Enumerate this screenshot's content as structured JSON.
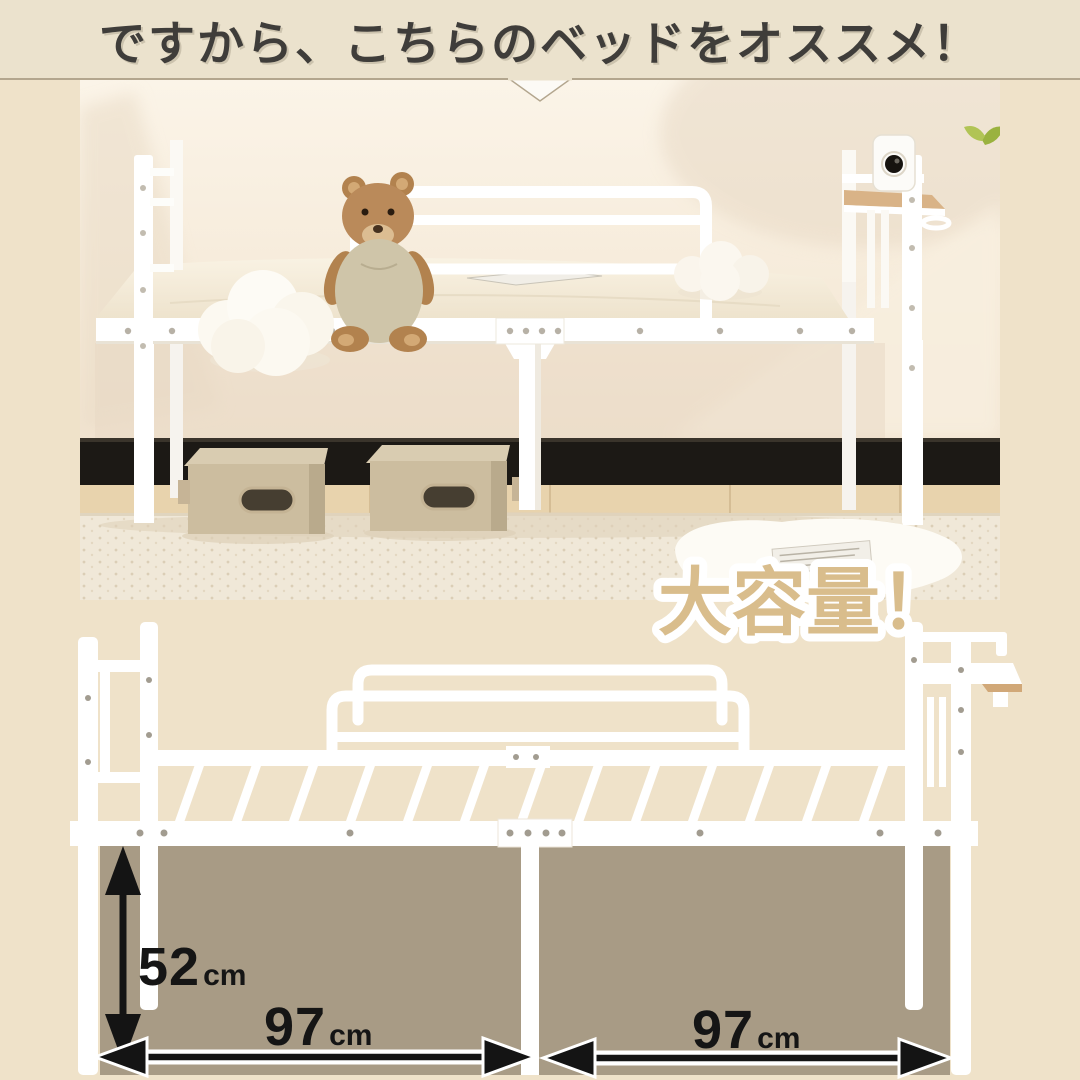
{
  "header": {
    "headline": "ですから、こちらのベッドをオススメ！"
  },
  "badge": {
    "label": "大容量！"
  },
  "diagram": {
    "height_dim": {
      "value": "52",
      "unit": "cm"
    },
    "width_dim_left": {
      "value": "97",
      "unit": "cm"
    },
    "width_dim_right": {
      "value": "97",
      "unit": "cm"
    }
  },
  "colors": {
    "page_background": "#efe2c9",
    "header_band": "#ebe2cd",
    "headline_text": "#3f3d3a",
    "badge_fill": "#d9bd8c",
    "badge_outline": "#ffffff",
    "underbed_shade": "#a89b85",
    "dimension_arrow": "#141414",
    "bed_frame": "#ffffff",
    "shelf_wood": "#d1a878"
  }
}
